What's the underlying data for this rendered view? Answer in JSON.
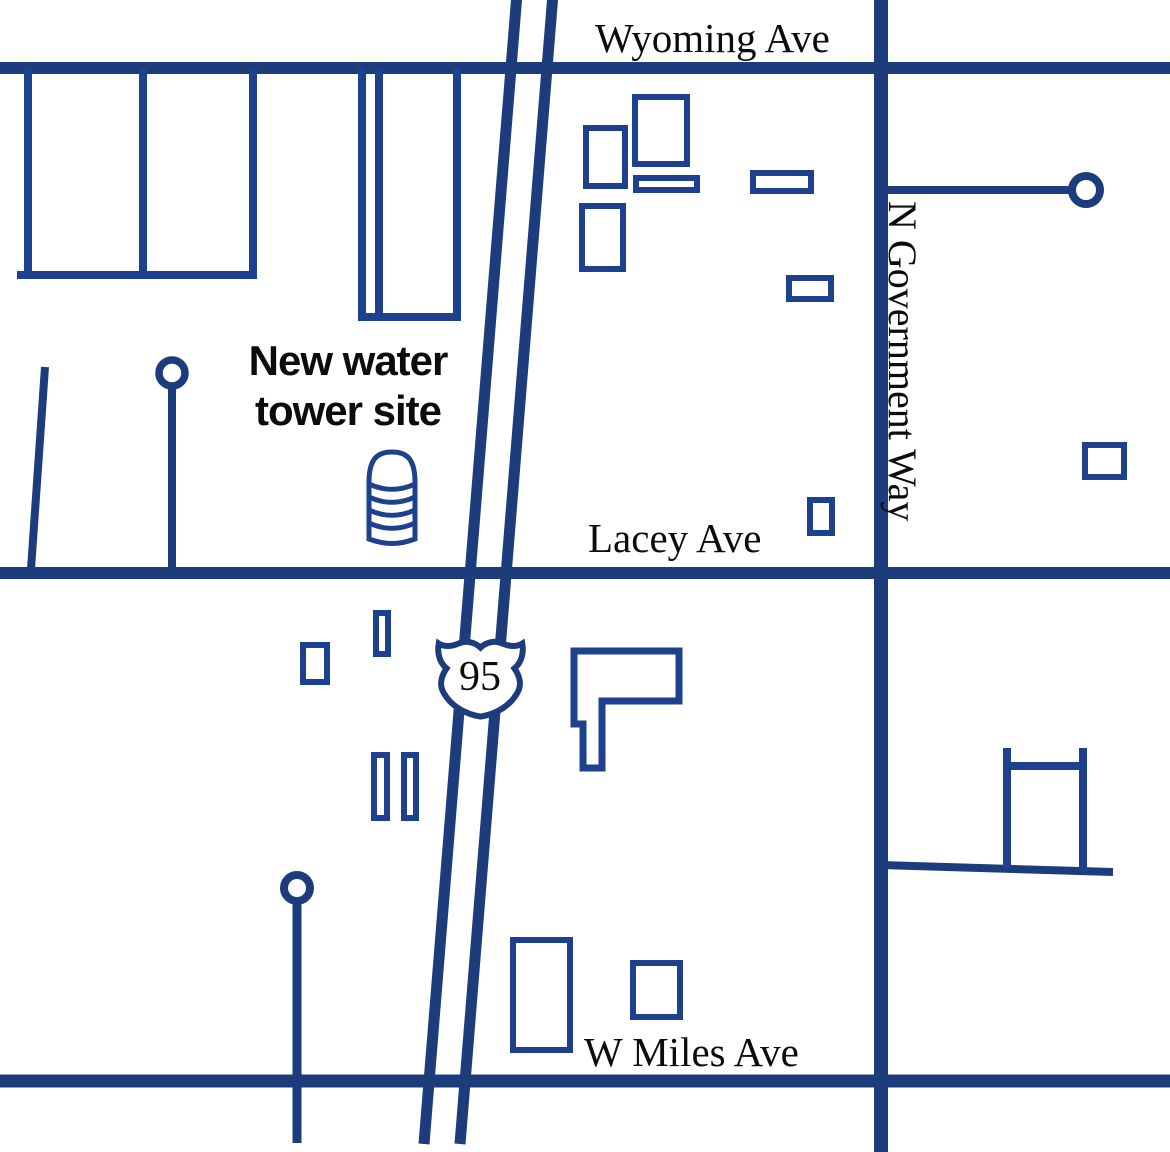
{
  "map": {
    "roads": {
      "wyoming": {
        "label": "Wyoming Ave"
      },
      "government_way": {
        "label": "N Government Way"
      },
      "lacey": {
        "label": "Lacey Ave"
      },
      "miles": {
        "label": "W Miles Ave"
      }
    },
    "highway": {
      "shield_number": "95"
    },
    "site_annotation": {
      "line1": "New water",
      "line2": "tower site"
    },
    "icons": {
      "water_tower": "water-tower-icon",
      "us_route_shield": "us-95-shield-icon",
      "cul_de_sac": "cul-de-sac-circle"
    },
    "colors": {
      "road": "#1c3c7c",
      "building": "#1d418f",
      "label": "#0c0c0c",
      "background": "#ffffff"
    }
  }
}
